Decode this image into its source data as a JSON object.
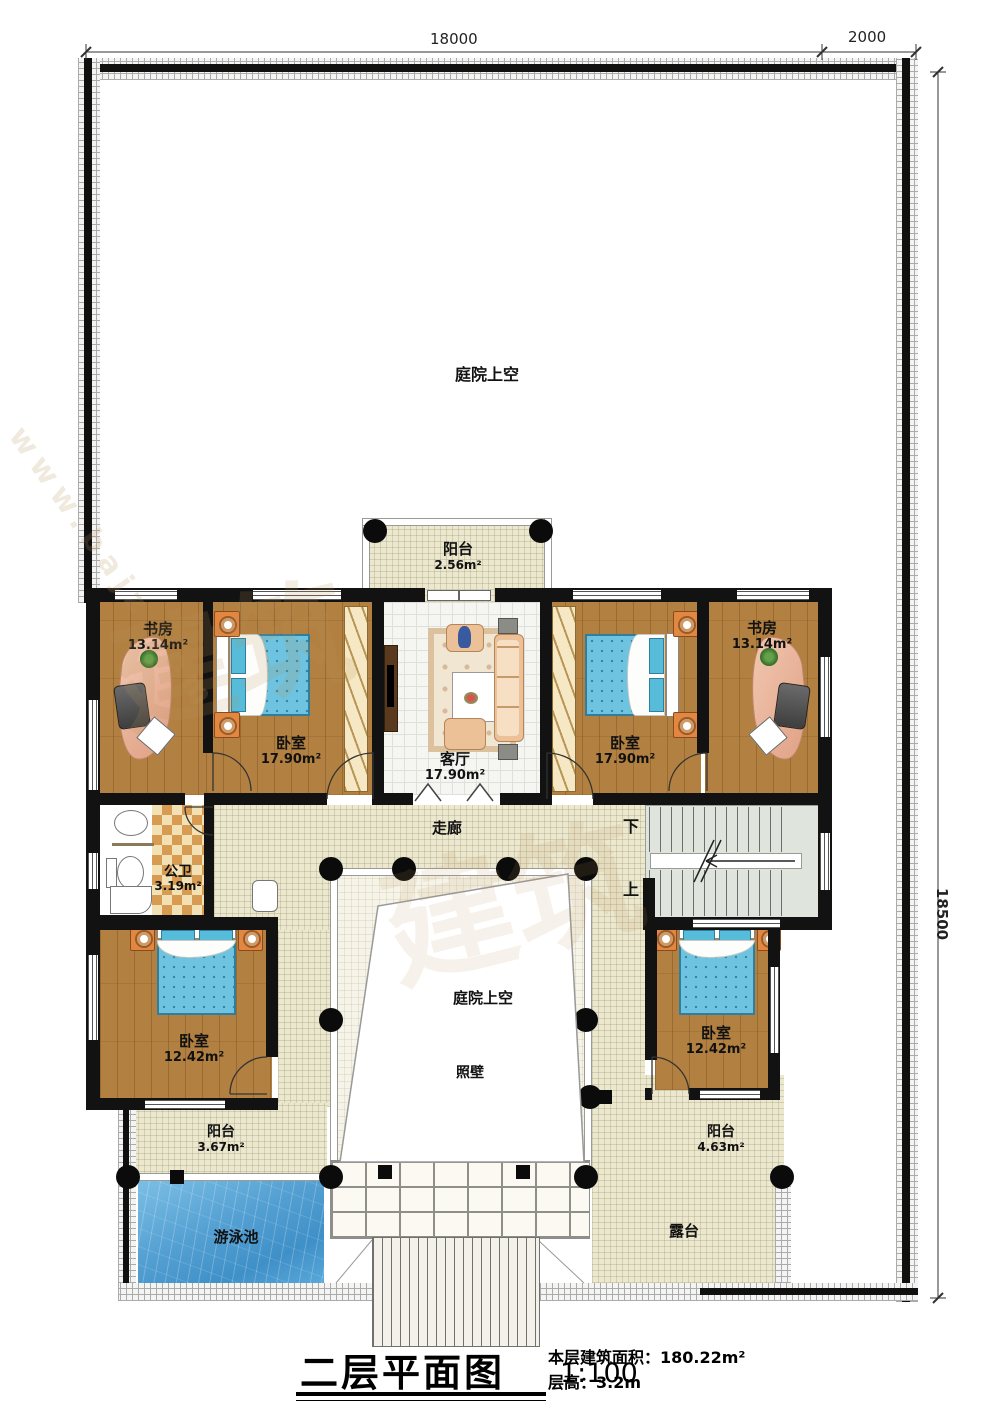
{
  "dimensions": {
    "top_main": "18000",
    "top_right": "2000",
    "right_side": "18500"
  },
  "rooms": {
    "courtyard_top": {
      "label": "庭院上空"
    },
    "balcony_top": {
      "label": "阳台",
      "area": "2.56m²"
    },
    "study_left": {
      "label": "书房",
      "area": "13.14m²"
    },
    "bedroom_top_left": {
      "label": "卧室",
      "area": "17.90m²"
    },
    "living_room": {
      "label": "客厅",
      "area": "17.90m²"
    },
    "bedroom_top_right": {
      "label": "卧室",
      "area": "17.90m²"
    },
    "study_right": {
      "label": "书房",
      "area": "13.14m²"
    },
    "corridor": {
      "label": "走廊"
    },
    "bathroom": {
      "label": "公卫",
      "area": "3.19m²"
    },
    "stairs": {
      "down": "下",
      "up": "上"
    },
    "bedroom_bottom_left": {
      "label": "卧室",
      "area": "12.42m²"
    },
    "courtyard_center": {
      "label": "庭院上空"
    },
    "screen_wall": {
      "label": "照壁"
    },
    "bedroom_bottom_right": {
      "label": "卧室",
      "area": "12.42m²"
    },
    "balcony_bottom_left": {
      "label": "阳台",
      "area": "3.67m²"
    },
    "pool": {
      "label": "游泳池"
    },
    "balcony_bottom_right": {
      "label": "阳台",
      "area": "4.63m²"
    },
    "terrace": {
      "label": "露台"
    }
  },
  "title_block": {
    "title": "二层平面图",
    "scale": "1:100",
    "area_line": "本层建筑面积：180.22m²",
    "height_line": "层高：3.2m"
  },
  "watermark": {
    "glyphs": "建筑",
    "site": "www.bajz.com"
  },
  "colors": {
    "wall": "#121212",
    "wood_floor": "#b28040",
    "pool_water": "#4f9fd2",
    "bed_fabric": "#6ec4e0",
    "corridor_floor": "#ece7cf"
  }
}
